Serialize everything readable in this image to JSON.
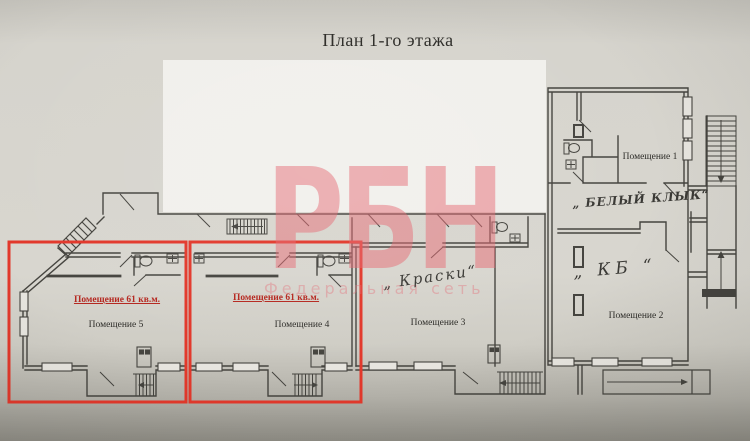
{
  "sheet": {
    "title": "План 1-го этажа"
  },
  "watermark": {
    "logo": "РБН",
    "tagline": "Федеральная сеть"
  },
  "highlight": {
    "color": "#e2382b",
    "area_label": "Помещение 61 кв.м."
  },
  "rooms": {
    "room1": {
      "name": "Помещение 1",
      "annotation": "„ БЕЛЫЙ КЛЫК“"
    },
    "room2": {
      "name": "Помещение 2",
      "annotation": "„ КБ “"
    },
    "room3": {
      "name": "Помещение 3",
      "annotation": "„ Краски“"
    },
    "room4": {
      "name": "Помещение 4",
      "area_label": "Помещение 61 кв.м."
    },
    "room5": {
      "name": "Помещение 5",
      "area_label": "Помещение 61 кв.м."
    }
  }
}
